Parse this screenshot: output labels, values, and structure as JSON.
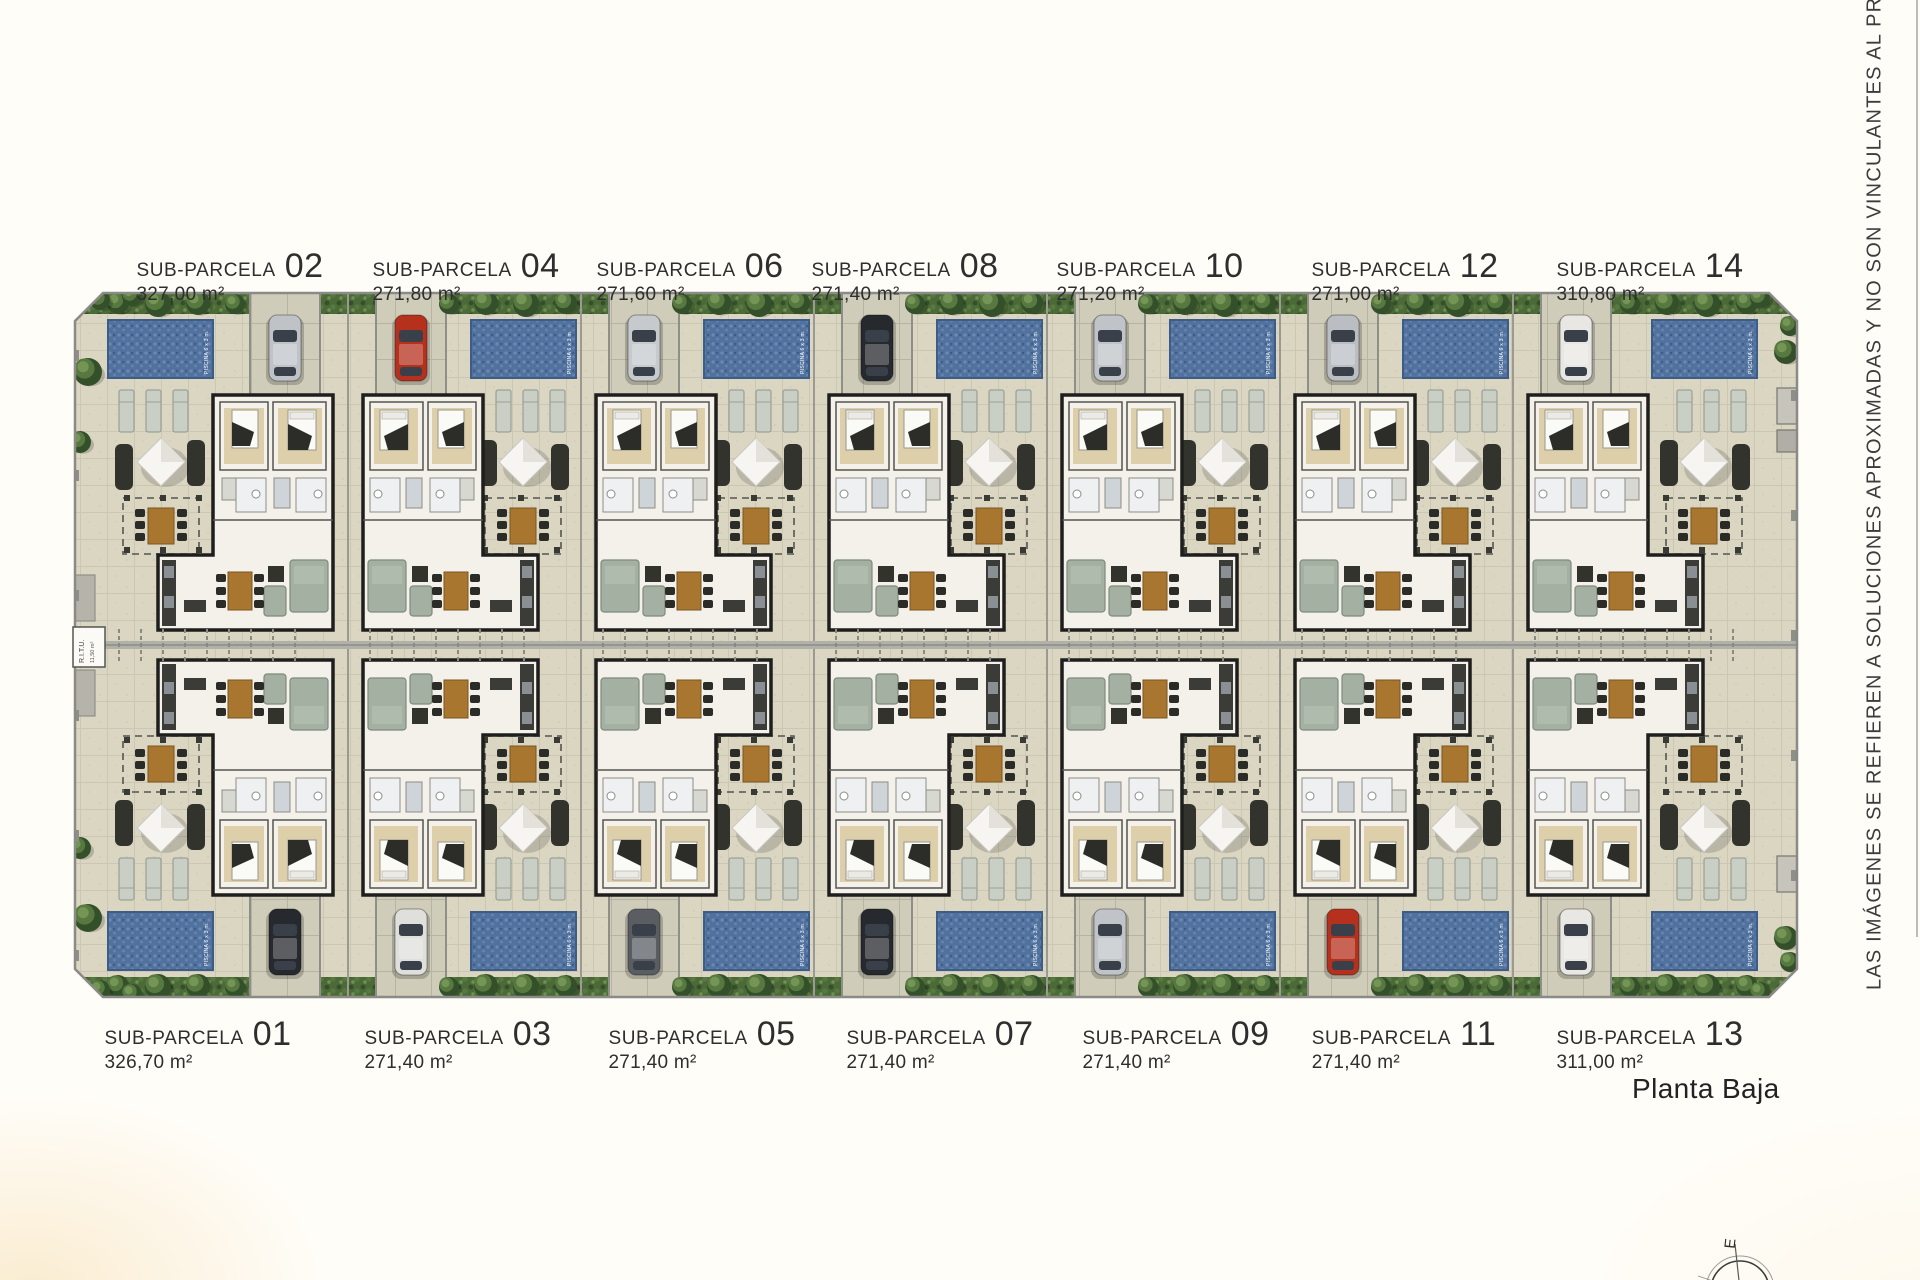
{
  "page": {
    "plan_title": "Planta Baja",
    "disclaimer_vertical": "LAS IMÁGENES SE REFIEREN A SOLUCIONES APROXIMADAS Y NO SON VINCULANTES AL PROYECT",
    "compass_label": "E"
  },
  "parcels": {
    "label_prefix": "SUB-PARCELA",
    "top": [
      {
        "number": "02",
        "area": "327,00 m²"
      },
      {
        "number": "04",
        "area": "271,80 m²"
      },
      {
        "number": "06",
        "area": "271,60 m²"
      },
      {
        "number": "08",
        "area": "271,40 m²"
      },
      {
        "number": "10",
        "area": "271,20 m²"
      },
      {
        "number": "12",
        "area": "271,00 m²"
      },
      {
        "number": "14",
        "area": "310,80 m²"
      }
    ],
    "bottom": [
      {
        "number": "01",
        "area": "326,70 m²"
      },
      {
        "number": "03",
        "area": "271,40 m²"
      },
      {
        "number": "05",
        "area": "271,40 m²"
      },
      {
        "number": "07",
        "area": "271,40 m²"
      },
      {
        "number": "09",
        "area": "271,40 m²"
      },
      {
        "number": "11",
        "area": "271,40 m²"
      },
      {
        "number": "13",
        "area": "311,00 m²"
      }
    ]
  },
  "plan_annotations": {
    "pool_label": "PISCINA 6 x 3 m.",
    "utility_label": "R.I.T.U.",
    "utility_sublabel": "11,50 m²"
  },
  "colors": {
    "terrace": "#dad6c2",
    "terrace_line": "#cbc7b2",
    "driveway": "#cfccba",
    "driveway_line": "#b7b4a2",
    "path_grey": "#b2b1a9",
    "wall_grey": "#8f8f89",
    "fence_grey": "#9b9a92",
    "pool_blue": "#51729f",
    "pool_blue_light": "#6d89ae",
    "pool_blue_dark": "#3d5d88",
    "hedge_green": "#4c6a38",
    "tree_green_dark": "#33502a",
    "tree_green_mid": "#577940",
    "tree_green_light": "#759556",
    "house_wall": "#1e1e1c",
    "house_floor": "#f3f1ea",
    "bedroom_floor": "#dccfa9",
    "bed_white": "#fafaf7",
    "sofa": "#a3b0a2",
    "table_wood": "#a9762f",
    "furniture_dark": "#33332e",
    "lounger": "#c9cfc4",
    "umbrella_white": "#f6f5f1",
    "car_glass": "#394049",
    "car_colors_top": [
      "#bfc3c8",
      "#b5301d",
      "#c6cacd",
      "#26292d",
      "#c0c4c8",
      "#babec3",
      "#e8e7e3"
    ],
    "car_colors_bottom": [
      "#26292d",
      "#dfdfdc",
      "#5a5e63",
      "#26292d",
      "#c0c4c8",
      "#b5301d",
      "#e8e7e3"
    ]
  }
}
